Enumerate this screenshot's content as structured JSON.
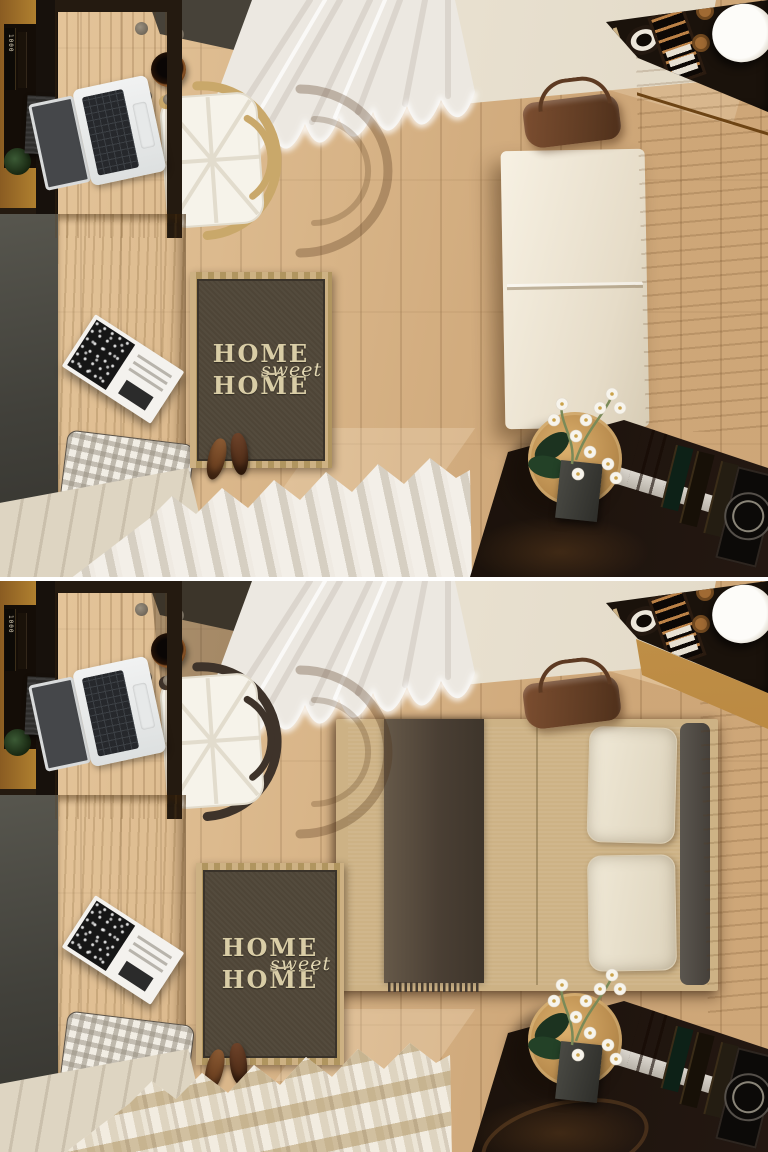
{
  "scene": {
    "type": "interior-render-top-view",
    "description": "Two stacked top-down 3D renders of the same small bedroom with a wall-folding murphy bed. Top panel: bed folded away (sofa mode). Bottom panel: bed folded down (bed mode).",
    "panels": [
      {
        "id": "sofa-mode",
        "caption": "Murphy bed closed - cream sofa cushions against the wood wardrobe panel",
        "chair_finish": "natural wood",
        "floor_curtain": "plain cream pleats"
      },
      {
        "id": "bed-mode",
        "caption": "Murphy bed open - cream duvet, brown fringed throw, two pillows, grey bolster",
        "chair_finish": "black stained wood",
        "floor_curtain": "striped beige pleats"
      }
    ],
    "objects": [
      "macbook laptop",
      "wooden desk",
      "wishbone chair",
      "white sheer curtains",
      "HOME sweet HOME rug",
      "pair of shoes",
      "gingham pillow",
      "open magazine",
      "window bench",
      "brown leather bag",
      "wall shelving with books",
      "round side table",
      "white orchid in vase",
      "murphy bed wardrobe",
      "plant pot",
      "round mirror",
      "suitcase"
    ]
  },
  "rug": {
    "line1": "HOME",
    "line2": "sweet",
    "line3": "HOME"
  },
  "book_spine_label": "1000",
  "palette": {
    "floor_wood": "#d7b487",
    "desk_wood": "#b5813c",
    "wardrobe_wood": "#b9883f",
    "wall_charcoal": "#4b4943",
    "shelf_black": "#171009",
    "ceiling_cream": "#e9e1d1",
    "curtain_white": "#ece8e1",
    "sofa_cream": "#f0e9da",
    "duvet_khaki": "#ddd3a9",
    "throw_brown": "#50453a",
    "rug_brown": "#4e4537",
    "rug_letters": "#d9cda6",
    "leather_bag": "#6e452c",
    "orchid_white": "#f7f4ec"
  }
}
